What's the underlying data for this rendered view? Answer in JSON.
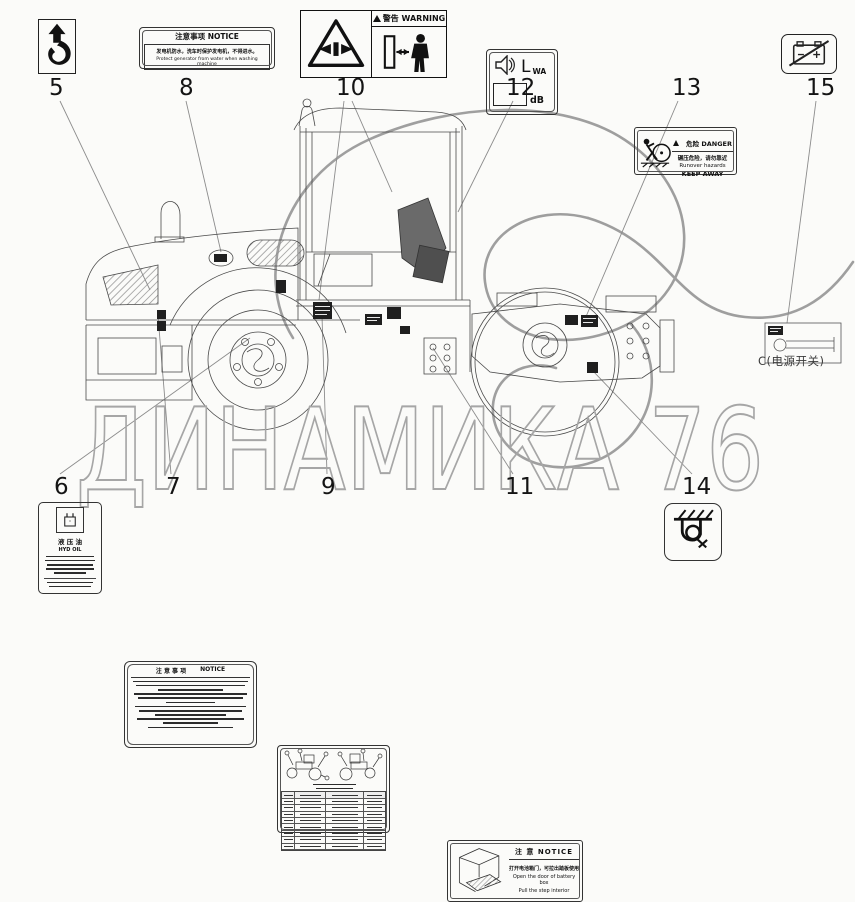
{
  "colors": {
    "line": "#4a4a4a",
    "decal": "#1f1f1f",
    "leader": "#8c8c8c",
    "watermark": "#a6a6a6",
    "swirl": "#808080"
  },
  "watermark": {
    "text": "ДИНАМИКА 76"
  },
  "detail": {
    "caption": "C(电源开关)"
  },
  "callouts": {
    "c5": "5",
    "c6": "6",
    "c7": "7",
    "c8": "8",
    "c9": "9",
    "c10": "10",
    "c11": "11",
    "c12": "12",
    "c13": "13",
    "c14": "14",
    "c15": "15"
  },
  "labels": {
    "label5": {
      "icon": "lifting-hook-icon"
    },
    "label6": {
      "line1": "液 压 油",
      "line2": "HYD OIL",
      "icon": "oil-can-icon"
    },
    "label7": {
      "title_cn": "注 意 事 项",
      "title_en": "NOTICE"
    },
    "label8": {
      "title": "注意事项  NOTICE",
      "line1": "发电机防水，洗车时保护发电机，不得进水。",
      "line2": "Protect generator from water when washing machine"
    },
    "label9": {
      "icon": "lubrication-chart-label"
    },
    "label10": {
      "title": "警告 WARNING",
      "left_icon": "crush-hazard-icon",
      "right_icon": "keep-distance-icon"
    },
    "label11": {
      "title": "注 意 NOTICE",
      "line1": "打开电池箱门，可拉出踏板使用",
      "line2": "Open the door of battery box",
      "line3": "Pull the step interior",
      "icon": "battery-box-drawing"
    },
    "label12": {
      "big": "L",
      "sub": "WA",
      "unit": "dB",
      "icon": "noise-level-speaker-icon"
    },
    "label13": {
      "title": "危险 DANGER",
      "line1": "碾压危险，请勿靠近",
      "line2": "Runover hazards",
      "line3": "KEEP AWAY",
      "icon": "runover-hazard-icon"
    },
    "label14": {
      "icon": "tie-down-icon"
    },
    "label15": {
      "icon": "battery-disconnect-icon"
    }
  }
}
